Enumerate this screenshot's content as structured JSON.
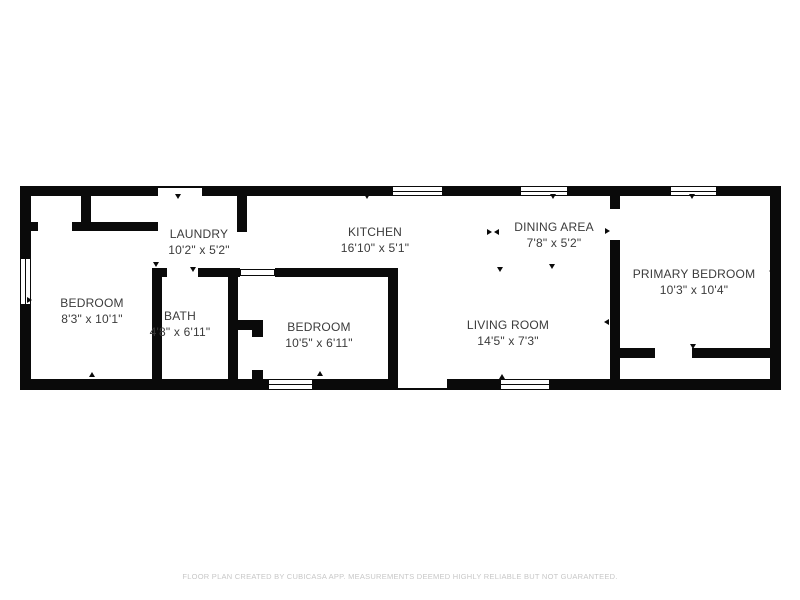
{
  "page": {
    "background": "#ffffff",
    "wall_color": "#0a0a0a",
    "label_color": "#3b3b3b",
    "footer_color": "#c7c7c7"
  },
  "footer": {
    "text": "FLOOR PLAN CREATED BY CUBICASA APP. MEASUREMENTS DEEMED HIGHLY RELIABLE BUT NOT GUARANTEED."
  },
  "plan": {
    "rooms": [
      {
        "id": "bedroom-1",
        "name": "BEDROOM",
        "dims": "8'3\" x 10'1\"",
        "cx": 92,
        "cy": 311
      },
      {
        "id": "laundry",
        "name": "LAUNDRY",
        "dims": "10'2\" x 5'2\"",
        "cx": 199,
        "cy": 242
      },
      {
        "id": "bath",
        "name": "BATH",
        "dims": "4'8\" x 6'11\"",
        "cx": 180,
        "cy": 324
      },
      {
        "id": "kitchen",
        "name": "KITCHEN",
        "dims": "16'10\" x 5'1\"",
        "cx": 375,
        "cy": 240
      },
      {
        "id": "bedroom-2",
        "name": "BEDROOM",
        "dims": "10'5\" x 6'11\"",
        "cx": 319,
        "cy": 335
      },
      {
        "id": "living-room",
        "name": "LIVING ROOM",
        "dims": "14'5\" x 7'3\"",
        "cx": 508,
        "cy": 333
      },
      {
        "id": "dining-area",
        "name": "DINING AREA",
        "dims": "7'8\" x 5'2\"",
        "cx": 554,
        "cy": 235
      },
      {
        "id": "primary-bedroom",
        "name": "PRIMARY BEDROOM",
        "dims": "10'3\" x 10'4\"",
        "cx": 694,
        "cy": 282
      }
    ],
    "walls": [
      [
        20,
        186,
        138,
        10
      ],
      [
        202,
        186,
        190,
        10
      ],
      [
        443,
        186,
        77,
        10
      ],
      [
        568,
        186,
        102,
        10
      ],
      [
        717,
        186,
        64,
        10
      ],
      [
        20,
        379,
        248,
        11
      ],
      [
        313,
        379,
        85,
        11
      ],
      [
        447,
        379,
        53,
        11
      ],
      [
        550,
        379,
        231,
        11
      ],
      [
        20,
        186,
        11,
        72
      ],
      [
        20,
        305,
        11,
        85
      ],
      [
        770,
        186,
        11,
        204
      ],
      [
        81,
        196,
        10,
        34
      ],
      [
        31,
        222,
        7,
        9
      ],
      [
        72,
        222,
        86,
        9
      ],
      [
        237,
        196,
        10,
        36
      ],
      [
        152,
        270,
        10,
        109
      ],
      [
        152,
        268,
        15,
        9
      ],
      [
        198,
        268,
        42,
        9
      ],
      [
        228,
        277,
        10,
        102
      ],
      [
        275,
        268,
        123,
        9
      ],
      [
        238,
        320,
        25,
        10
      ],
      [
        252,
        330,
        11,
        7
      ],
      [
        252,
        370,
        11,
        9
      ],
      [
        388,
        277,
        10,
        102
      ],
      [
        610,
        196,
        10,
        13
      ],
      [
        610,
        240,
        10,
        139
      ],
      [
        620,
        348,
        35,
        10
      ],
      [
        692,
        348,
        78,
        10
      ]
    ],
    "windows": [
      {
        "x": 20,
        "y": 258,
        "w": 11,
        "h": 47,
        "o": "v"
      },
      {
        "x": 392,
        "y": 186,
        "w": 51,
        "h": 10,
        "o": "h"
      },
      {
        "x": 520,
        "y": 186,
        "w": 48,
        "h": 10,
        "o": "h"
      },
      {
        "x": 670,
        "y": 186,
        "w": 47,
        "h": 10,
        "o": "h"
      },
      {
        "x": 268,
        "y": 379,
        "w": 45,
        "h": 11,
        "o": "h"
      },
      {
        "x": 500,
        "y": 379,
        "w": 50,
        "h": 11,
        "o": "h"
      }
    ],
    "openings": [
      {
        "x": 158,
        "y": 186,
        "w": 44,
        "h": 2
      },
      {
        "x": 398,
        "y": 388,
        "w": 49,
        "h": 2
      },
      {
        "x": 240,
        "y": 269,
        "w": 35,
        "h": 7
      }
    ],
    "markers": [
      {
        "x": 178,
        "y": 197,
        "d": "down"
      },
      {
        "x": 87,
        "y": 209,
        "d": "right"
      },
      {
        "x": 90,
        "y": 228,
        "d": "down"
      },
      {
        "x": 30,
        "y": 300,
        "d": "right"
      },
      {
        "x": 92,
        "y": 375,
        "d": "up"
      },
      {
        "x": 242,
        "y": 226,
        "d": "down"
      },
      {
        "x": 156,
        "y": 265,
        "d": "down"
      },
      {
        "x": 193,
        "y": 270,
        "d": "down"
      },
      {
        "x": 283,
        "y": 271,
        "d": "down"
      },
      {
        "x": 320,
        "y": 374,
        "d": "up"
      },
      {
        "x": 367,
        "y": 197,
        "d": "down"
      },
      {
        "x": 490,
        "y": 232,
        "d": "right"
      },
      {
        "x": 497,
        "y": 232,
        "d": "left"
      },
      {
        "x": 500,
        "y": 270,
        "d": "down"
      },
      {
        "x": 552,
        "y": 267,
        "d": "down"
      },
      {
        "x": 553,
        "y": 197,
        "d": "down"
      },
      {
        "x": 608,
        "y": 231,
        "d": "right"
      },
      {
        "x": 615,
        "y": 271,
        "d": "right"
      },
      {
        "x": 607,
        "y": 322,
        "d": "left"
      },
      {
        "x": 692,
        "y": 197,
        "d": "down"
      },
      {
        "x": 693,
        "y": 347,
        "d": "down"
      },
      {
        "x": 772,
        "y": 271,
        "d": "left"
      },
      {
        "x": 502,
        "y": 377,
        "d": "up"
      },
      {
        "x": 233,
        "y": 297,
        "d": "right"
      }
    ]
  }
}
